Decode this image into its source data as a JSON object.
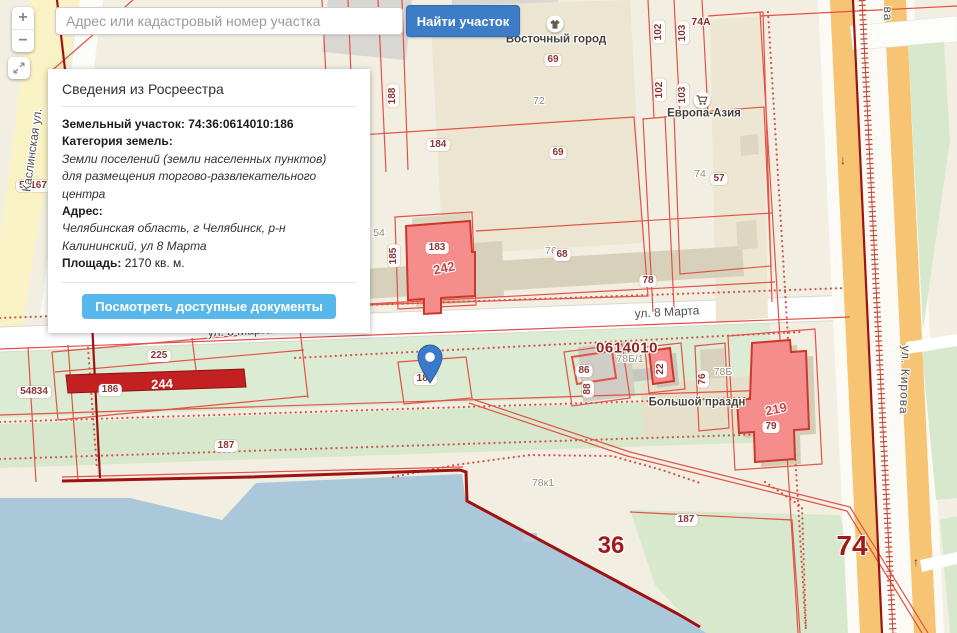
{
  "search": {
    "placeholder": "Адрес или кадастровый номер участка",
    "find_button": "Найти участок"
  },
  "controls": {
    "zoom_in": "+",
    "zoom_out": "−"
  },
  "info_panel": {
    "title": "Сведения из Росреестра",
    "parcel_label": "Земельный участок:",
    "parcel_number": "74:36:0614010:186",
    "category_label": "Категория земель:",
    "category_value": "Земли поселений (земли населенных пунктов)",
    "usage_value": "для размещения торгово-развлекательного центра",
    "address_label": "Адрес:",
    "address_value": "Челябинская область, г Челябинск, р-н Калининский, ул 8 Марта",
    "area_label": "Площадь:",
    "area_value": "2170 кв. м.",
    "documents_button": "Посмотреть доступные документы"
  },
  "map": {
    "quarter_number": "0614010",
    "streets": [
      {
        "name": "ул. 8 Марта"
      },
      {
        "name": "ул. 8 Марта"
      },
      {
        "name": "ул. Кирова"
      },
      {
        "name": "ва"
      },
      {
        "name": "Каслинская ул."
      }
    ],
    "pois": [
      {
        "name": "Восточный город",
        "icon": "tshirt-icon"
      },
      {
        "name": "Европа-Азия",
        "icon": "cart-icon"
      },
      {
        "name": "Большой праздн",
        "icon": ""
      }
    ],
    "labels": [
      {
        "text": "69"
      },
      {
        "text": "72"
      },
      {
        "text": "69"
      },
      {
        "text": "188"
      },
      {
        "text": "184"
      },
      {
        "text": "102"
      },
      {
        "text": "103"
      },
      {
        "text": "102"
      },
      {
        "text": "103"
      },
      {
        "text": "74А"
      },
      {
        "text": "74"
      },
      {
        "text": "57"
      },
      {
        "text": "54"
      },
      {
        "text": "185"
      },
      {
        "text": "183"
      },
      {
        "text": "242"
      },
      {
        "text": "76"
      },
      {
        "text": "68"
      },
      {
        "text": "78"
      },
      {
        "text": "225"
      },
      {
        "text": "186"
      },
      {
        "text": "244"
      },
      {
        "text": "53167"
      },
      {
        "text": "54834"
      },
      {
        "text": "186"
      },
      {
        "text": "78Б/1"
      },
      {
        "text": "86"
      },
      {
        "text": "88"
      },
      {
        "text": "22"
      },
      {
        "text": "76"
      },
      {
        "text": "78Б"
      },
      {
        "text": "219"
      },
      {
        "text": "79"
      },
      {
        "text": "187"
      },
      {
        "text": "187"
      },
      {
        "text": "78к1"
      },
      {
        "text": "36"
      },
      {
        "text": "74"
      },
      {
        "text": "↓"
      },
      {
        "text": "↑"
      }
    ]
  },
  "colors": {
    "find_button": "#3d7dc8",
    "documents_button": "#57b7ea",
    "pin": "#3a7ac9",
    "parcel_outline": "#e25247",
    "selected_fill": "#f58d8d",
    "highlight_bar": "#c32121",
    "boundary_dark": "#9e1212"
  }
}
